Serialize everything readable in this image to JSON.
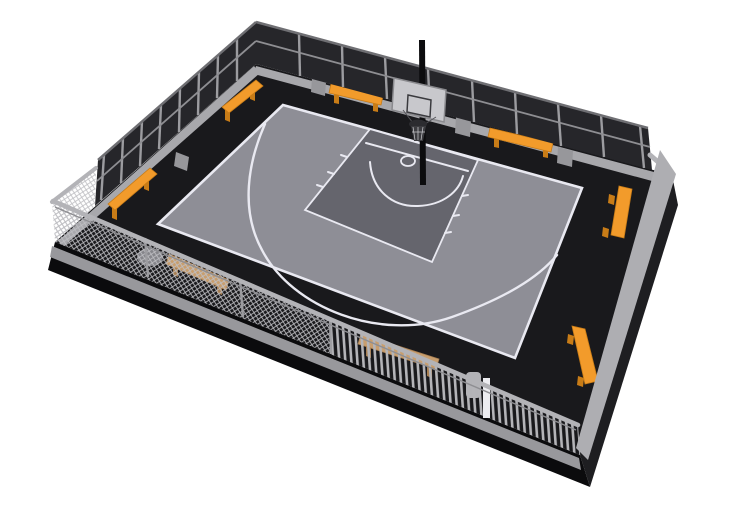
{
  "meta": {
    "title": "3D basketball court render",
    "description": "3D render of a fenced outdoor basketball half-court: dark enclosure walls at the back, chain-link and slat fencing at the front, grey court surface with white markings and a single hoop with grey backboard, orange benches and litter bins, all on a black base over a white background."
  },
  "colors": {
    "bg": "#ffffff",
    "slab_left": "#0b0b0d",
    "slab_right": "#1e1e21",
    "apron": "#19191c",
    "court": "#8e8e96",
    "key": "#65656d",
    "line": "#e9e9f1",
    "wall": "#26262a",
    "wall_cap": "#6f6f73",
    "post": "#9c9ca0",
    "mid_rail": "#8e8e92",
    "ledge": "#a8a8ac",
    "tab": "#97979b",
    "rail": "#b3b3b7",
    "curb": "#98989c",
    "se_band": "#aeaeb2",
    "mesh_line": "#bfbfc3",
    "slat_line": "#b4b4b8",
    "bench": "#f29b2b",
    "bench_dark": "#c87c17",
    "bench_tan": "#c89e6e",
    "bench_tan_dark": "#a87f52",
    "board": "#c8c8cc",
    "board_edge": "#8a8a8e",
    "board_inner": "#3a3a3e",
    "rim": "#2c2c30",
    "net_dark": "#3c3c40",
    "net": "#cfcfd3",
    "pole": "#0c0c0e",
    "can_dark": "#85858a",
    "can_light": "#b3b3b7",
    "gate_post": "#ececf0"
  },
  "scene": {
    "objects": [
      {
        "id": "enclosure-wall",
        "label": "Dark perimeter wall",
        "count": 2
      },
      {
        "id": "chain-link-fence",
        "label": "Chain-link fence section",
        "count": 2
      },
      {
        "id": "slat-fence",
        "label": "Slat fence section",
        "count": 1
      },
      {
        "id": "court",
        "label": "Basketball half-court",
        "count": 1
      },
      {
        "id": "hoop",
        "label": "Basketball hoop with backboard",
        "count": 1
      },
      {
        "id": "bench",
        "label": "Bench",
        "count": 8
      },
      {
        "id": "litter-bin",
        "label": "Litter bin",
        "count": 2
      },
      {
        "id": "gate-post",
        "label": "Gate post",
        "count": 1
      }
    ]
  }
}
